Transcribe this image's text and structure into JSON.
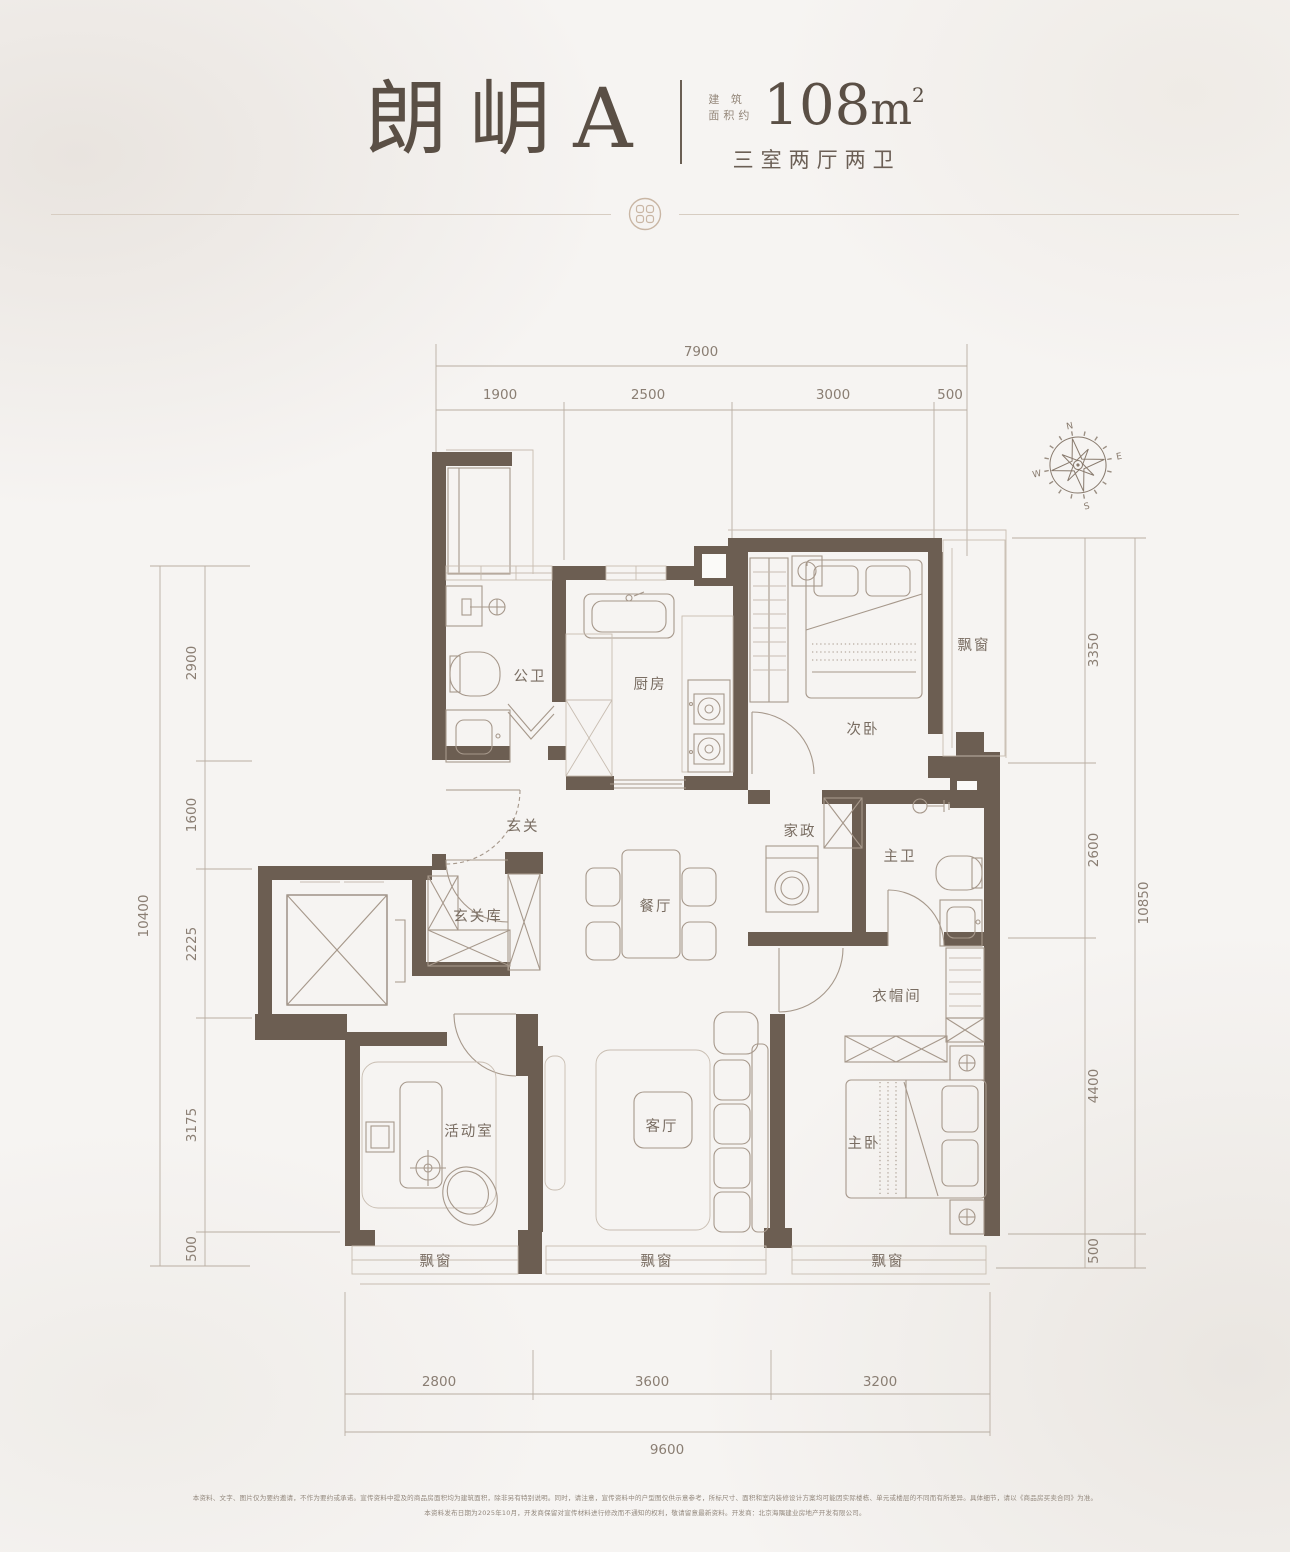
{
  "header": {
    "unit_name": "朗岄A",
    "area_label_line1": "建 筑",
    "area_label_line2": "面积约",
    "area_value": "108",
    "area_unit": "m",
    "area_sup": "2",
    "layout_desc": "三室两厅两卫"
  },
  "compass": {
    "n": "N",
    "e": "E",
    "s": "S",
    "w": "W"
  },
  "rooms": {
    "bath_public": "公卫",
    "kitchen": "厨房",
    "bedroom_second": "次卧",
    "bay_window": "飘窗",
    "foyer": "玄关",
    "foyer_storage": "玄关库",
    "dining": "餐厅",
    "housekeeping": "家政",
    "bath_master": "主卫",
    "cloakroom": "衣帽间",
    "activity_room": "活动室",
    "living_room": "客厅",
    "bedroom_master": "主卧"
  },
  "dimensions": {
    "top": {
      "total": "7900",
      "segments": [
        "1900",
        "2500",
        "3000",
        "500"
      ]
    },
    "left": {
      "total": "10400",
      "segments": [
        "2900",
        "1600",
        "2225",
        "3175",
        "500"
      ]
    },
    "right": {
      "total": "10850",
      "segments": [
        "3350",
        "2600",
        "4400",
        "500"
      ]
    },
    "bottom": {
      "total": "9600",
      "segments": [
        "2800",
        "3600",
        "3200"
      ]
    }
  },
  "footer": {
    "line1": "本资料、文字、图片仅为要约邀请，不作为要约或承诺。宣传资料中提及的商品房面积均为建筑面积，除非另有特别说明。同时，请注意，宣传资料中的户型图仅供示意参考，所标尺寸、面积和室内装修设计方案均可能因实际楼栋、单元或楼层的不同而有所差异。具体细节，请以《商品房买卖合同》为准。",
    "line2": "本资料发布日期为2025年10月，开发商保留对宣传材料进行修改而不通知的权利，敬请留意最新资料。开发商：北京海隅建业房地产开发有限公司。"
  },
  "colors": {
    "wall": "#6c5e52",
    "accent": "#c9b6a4",
    "dim_text": "#8a7e73",
    "title": "#5a4f45"
  }
}
